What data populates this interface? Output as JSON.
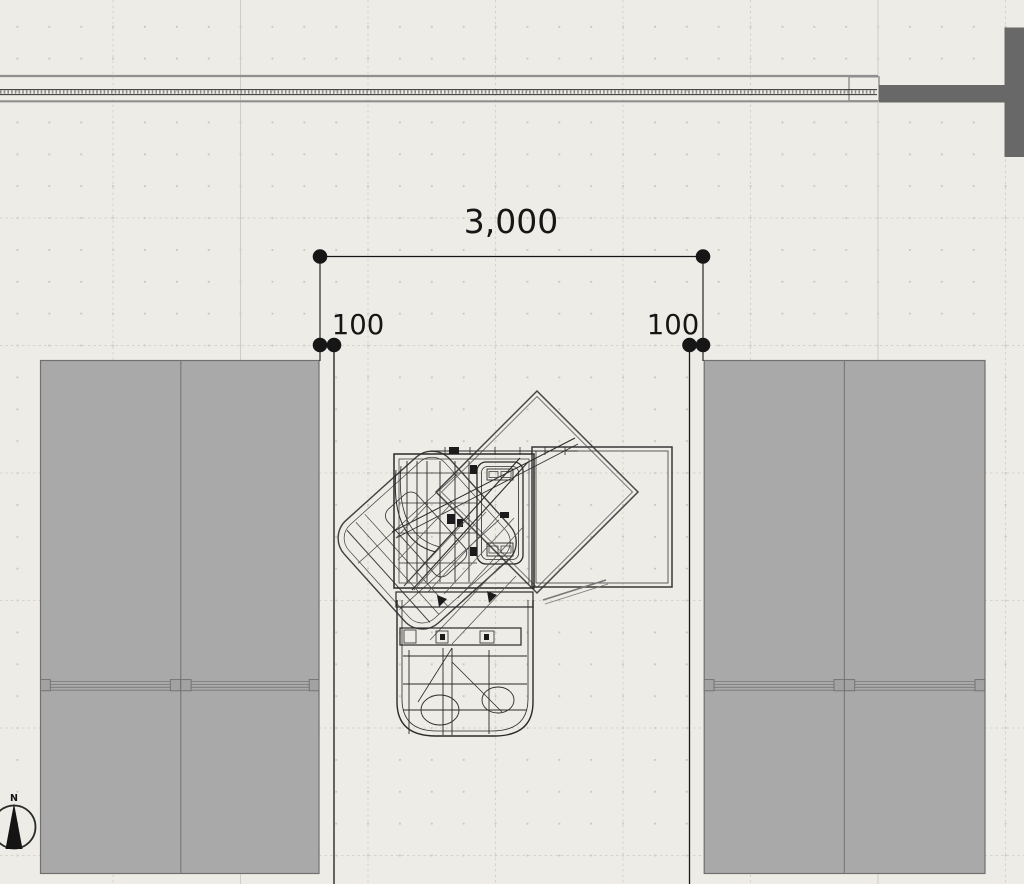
{
  "canvas": {
    "dimensions": {
      "total": "3,000",
      "left_offset": "100",
      "right_offset": "100"
    },
    "compass": {
      "label": "N"
    }
  },
  "colors": {
    "background": "#eeece6",
    "grid_dot": "#cac7bf",
    "grid_dashed_line": "#d8d3ca",
    "grid_solid_line": "#d0cdc5",
    "panel_fill": "#a9a9a9",
    "panel_outline": "#707070",
    "dark_wall_fill": "#686868",
    "wall_face_line": "#8f8f8f",
    "wall_core_line": "#2f2f2f",
    "drawing_line": "#2a2a2a",
    "dimension_ink": "#161616"
  }
}
